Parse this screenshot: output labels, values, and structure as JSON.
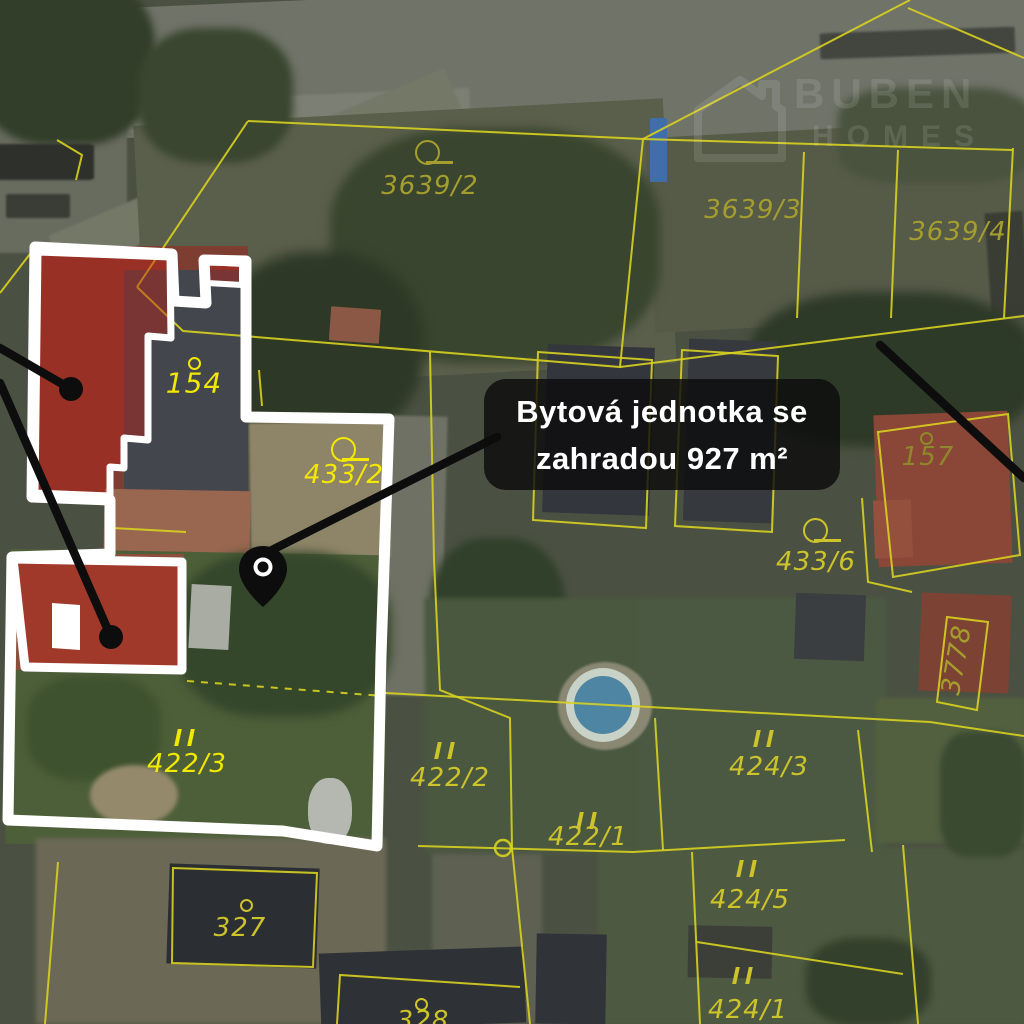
{
  "callout": {
    "line1": "Bytová jednotka se",
    "line2": "zahradou 927 m²"
  },
  "watermark": {
    "brand_line1": "BUBEN",
    "brand_line2": "HOMES"
  },
  "parcel_labels": [
    {
      "id": "3639-2",
      "text": "3639/2",
      "x": 430,
      "y": 186,
      "tier": "dim",
      "symbol": "flag",
      "sx": 415,
      "sy": 140
    },
    {
      "id": "3639-3",
      "text": "3639/3",
      "x": 753,
      "y": 210,
      "tier": "dim"
    },
    {
      "id": "3639-4",
      "text": "3639/4",
      "x": 958,
      "y": 232,
      "tier": "dim"
    },
    {
      "id": "154",
      "text": "154",
      "x": 194,
      "y": 383,
      "tier": "bright",
      "size": 28,
      "symbol": "dot",
      "sx": 188,
      "sy": 357
    },
    {
      "id": "433-2",
      "text": "433/2",
      "x": 344,
      "y": 475,
      "tier": "bright",
      "symbol": "flag",
      "sx": 331,
      "sy": 437
    },
    {
      "id": "157",
      "text": "157",
      "x": 928,
      "y": 457,
      "tier": "dark",
      "symbol": "dot",
      "sx": 920,
      "sy": 432
    },
    {
      "id": "433-6",
      "text": "433/6",
      "x": 816,
      "y": 562,
      "tier": "mid",
      "symbol": "flag",
      "sx": 803,
      "sy": 518
    },
    {
      "id": "3778",
      "text": "3778",
      "x": 957,
      "y": 660,
      "tier": "dim",
      "rotate": -80
    },
    {
      "id": "422-3",
      "text": "422/3",
      "x": 187,
      "y": 764,
      "tier": "bright",
      "symbol": "bars",
      "sx": 176,
      "sy": 729
    },
    {
      "id": "422-2",
      "text": "422/2",
      "x": 450,
      "y": 778,
      "tier": "mid",
      "symbol": "bars",
      "sx": 436,
      "sy": 742
    },
    {
      "id": "422-1",
      "text": "422/1",
      "x": 588,
      "y": 837,
      "tier": "mid",
      "symbol": "bars",
      "sx": 578,
      "sy": 812
    },
    {
      "id": "424-3",
      "text": "424/3",
      "x": 769,
      "y": 767,
      "tier": "mid",
      "symbol": "bars",
      "sx": 755,
      "sy": 730
    },
    {
      "id": "424-5",
      "text": "424/5",
      "x": 750,
      "y": 900,
      "tier": "mid",
      "symbol": "bars",
      "sx": 738,
      "sy": 860
    },
    {
      "id": "327",
      "text": "327",
      "x": 240,
      "y": 928,
      "tier": "mid",
      "symbol": "dot",
      "sx": 240,
      "sy": 899
    },
    {
      "id": "424-1",
      "text": "424/1",
      "x": 748,
      "y": 1010,
      "tier": "mid",
      "symbol": "bars",
      "sx": 734,
      "sy": 967
    },
    {
      "id": "328",
      "text": "328",
      "x": 423,
      "y": 1021,
      "tier": "mid",
      "symbol": "dot",
      "sx": 415,
      "sy": 998
    }
  ],
  "cadastral": {
    "lines": [
      {
        "points": [
          [
            137,
            287
          ],
          [
            248,
            121
          ]
        ]
      },
      {
        "points": [
          [
            248,
            121
          ],
          [
            643,
            139
          ]
        ]
      },
      {
        "points": [
          [
            643,
            139
          ],
          [
            910,
            0
          ]
        ]
      },
      {
        "points": [
          [
            908,
            8
          ],
          [
            1024,
            58
          ]
        ]
      },
      {
        "points": [
          [
            643,
            139
          ],
          [
            1012,
            150
          ]
        ]
      },
      {
        "points": [
          [
            137,
            287
          ],
          [
            183,
            331
          ],
          [
            620,
            367
          ],
          [
            643,
            139
          ]
        ]
      },
      {
        "points": [
          [
            804,
            152
          ],
          [
            797,
            318
          ]
        ]
      },
      {
        "points": [
          [
            898,
            150
          ],
          [
            891,
            318
          ]
        ]
      },
      {
        "points": [
          [
            1013,
            148
          ],
          [
            1004,
            318
          ]
        ]
      },
      {
        "points": [
          [
            620,
            367
          ],
          [
            1024,
            316
          ]
        ]
      },
      {
        "points": [
          [
            430,
            352
          ],
          [
            434,
            560
          ],
          [
            440,
            690
          ],
          [
            510,
            718
          ],
          [
            512,
            848
          ],
          [
            530,
            1024
          ]
        ]
      },
      {
        "points": [
          [
            418,
            846
          ],
          [
            633,
            852
          ],
          [
            845,
            840
          ]
        ]
      },
      {
        "points": [
          [
            655,
            718
          ],
          [
            663,
            850
          ]
        ]
      },
      {
        "points": [
          [
            385,
            693
          ],
          [
            930,
            722
          ],
          [
            1024,
            736
          ]
        ]
      },
      {
        "points": [
          [
            947,
            617
          ],
          [
            988,
            622
          ],
          [
            977,
            710
          ],
          [
            937,
            702
          ]
        ],
        "closed": true
      },
      {
        "points": [
          [
            858,
            730
          ],
          [
            872,
            852
          ]
        ]
      },
      {
        "points": [
          [
            692,
            852
          ],
          [
            700,
            1024
          ]
        ]
      },
      {
        "points": [
          [
            903,
            845
          ],
          [
            918,
            1024
          ]
        ]
      },
      {
        "points": [
          [
            697,
            942
          ],
          [
            903,
            974
          ]
        ]
      },
      {
        "points": [
          [
            173,
            868
          ],
          [
            317,
            873
          ],
          [
            313,
            967
          ],
          [
            172,
            963
          ]
        ],
        "closed": true
      },
      {
        "points": [
          [
            337,
            1024
          ],
          [
            340,
            975
          ],
          [
            520,
            987
          ]
        ]
      },
      {
        "points": [
          [
            58,
            862
          ],
          [
            45,
            1024
          ]
        ]
      },
      {
        "points": [
          [
            878,
            432
          ],
          [
            1008,
            414
          ],
          [
            1020,
            555
          ],
          [
            893,
            577
          ]
        ],
        "closed": true
      },
      {
        "points": [
          [
            862,
            498
          ],
          [
            868,
            582
          ],
          [
            912,
            592
          ]
        ]
      },
      {
        "points": [
          [
            538,
            352
          ],
          [
            652,
            360
          ],
          [
            646,
            528
          ],
          [
            533,
            520
          ]
        ],
        "closed": true
      },
      {
        "points": [
          [
            682,
            350
          ],
          [
            778,
            356
          ],
          [
            772,
            532
          ],
          [
            675,
            526
          ]
        ],
        "closed": true
      },
      {
        "points": [
          [
            57,
            140
          ],
          [
            82,
            155
          ],
          [
            76,
            180
          ]
        ]
      },
      {
        "points": [
          [
            0,
            293
          ],
          [
            33,
            250
          ]
        ]
      },
      {
        "points": [
          [
            259,
            370
          ],
          [
            262,
            406
          ]
        ]
      },
      {
        "points": [
          [
            113,
            528
          ],
          [
            186,
            532
          ]
        ]
      },
      {
        "points": [
          [
            187,
            681
          ],
          [
            383,
            696
          ]
        ],
        "dashed": true
      }
    ],
    "circles": [
      {
        "x": 503,
        "y": 848,
        "r": 8
      }
    ]
  },
  "property": {
    "outline_main": [
      [
        35,
        247
      ],
      [
        172,
        254
      ],
      [
        174,
        301
      ],
      [
        206,
        303
      ],
      [
        204,
        260
      ],
      [
        246,
        261
      ],
      [
        246,
        417
      ],
      [
        389,
        419
      ],
      [
        381,
        656
      ],
      [
        377,
        846
      ],
      [
        283,
        831
      ],
      [
        8,
        820
      ],
      [
        12,
        557
      ],
      [
        110,
        554
      ],
      [
        110,
        500
      ],
      [
        32,
        497
      ]
    ],
    "red_upper_main": [
      [
        38,
        252
      ],
      [
        170,
        257
      ],
      [
        171,
        338
      ],
      [
        148,
        336
      ],
      [
        148,
        440
      ],
      [
        124,
        438
      ],
      [
        124,
        468
      ],
      [
        110,
        467
      ],
      [
        110,
        496
      ],
      [
        35,
        493
      ]
    ],
    "red_upper_strip": [
      [
        206,
        262
      ],
      [
        242,
        264
      ],
      [
        242,
        285
      ],
      [
        207,
        283
      ]
    ],
    "building_lower": [
      [
        13,
        559
      ],
      [
        182,
        562
      ],
      [
        182,
        670
      ],
      [
        25,
        667
      ]
    ],
    "red_lower": [
      [
        16,
        561
      ],
      [
        179,
        564
      ],
      [
        179,
        666
      ],
      [
        28,
        664
      ]
    ],
    "white_notch_lower": [
      [
        52,
        603
      ],
      [
        80,
        605
      ],
      [
        80,
        650
      ],
      [
        52,
        648
      ]
    ]
  },
  "markers": {
    "pin": {
      "x": 263,
      "y": 566
    },
    "dots": [
      {
        "x": 71,
        "y": 389
      },
      {
        "x": 111,
        "y": 637
      }
    ],
    "lines": [
      [
        [
          0,
          348
        ],
        [
          71,
          389
        ]
      ],
      [
        [
          0,
          383
        ],
        [
          111,
          637
        ]
      ],
      [
        [
          266,
          553
        ],
        [
          497,
          437
        ]
      ],
      [
        [
          880,
          345
        ],
        [
          1024,
          478
        ]
      ]
    ]
  },
  "colors": {
    "cadastral_yellow": "#d8d21f",
    "label_bright": "#f2e800",
    "label_mid": "#cdc32b",
    "label_dim": "#a59e2e",
    "label_dark": "#8f872b",
    "outline_white": "#ffffff",
    "highlight_red": "rgba(186,34,24,0.45)",
    "callout_bg": "rgba(12,12,12,0.82)",
    "callout_text": "#ffffff",
    "marker_black": "#0d0d0d"
  }
}
